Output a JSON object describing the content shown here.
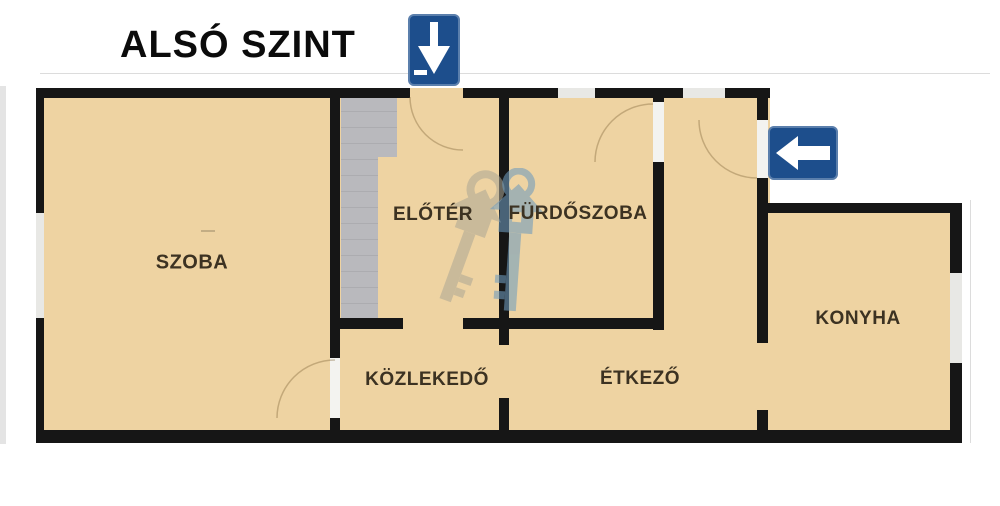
{
  "title": "ALSÓ SZINT",
  "rooms": [
    {
      "id": "szoba",
      "label": "SZOBA"
    },
    {
      "id": "eloter",
      "label": "ELŐTÉR"
    },
    {
      "id": "furdoszoba",
      "label": "FÜRDŐSZOBA"
    },
    {
      "id": "konyha",
      "label": "KONYHA"
    },
    {
      "id": "kozlekedo",
      "label": "KÖZLEKEDŐ"
    },
    {
      "id": "etkezo",
      "label": "ÉTKEZŐ"
    }
  ],
  "icons": {
    "down_arrow_sign": "down-arrow-sign",
    "left_arrow_sign": "left-arrow-sign",
    "watermark": "keys-house-watermark-logo",
    "stairs": "staircase"
  },
  "colors": {
    "floor_tan": "#eed3a2",
    "wall_black": "#161616",
    "sign_blue": "#1d4e8c",
    "stairs_gray": "#b9b9bd",
    "label_brown": "#3c3222",
    "window_light": "#e8e8e5"
  }
}
